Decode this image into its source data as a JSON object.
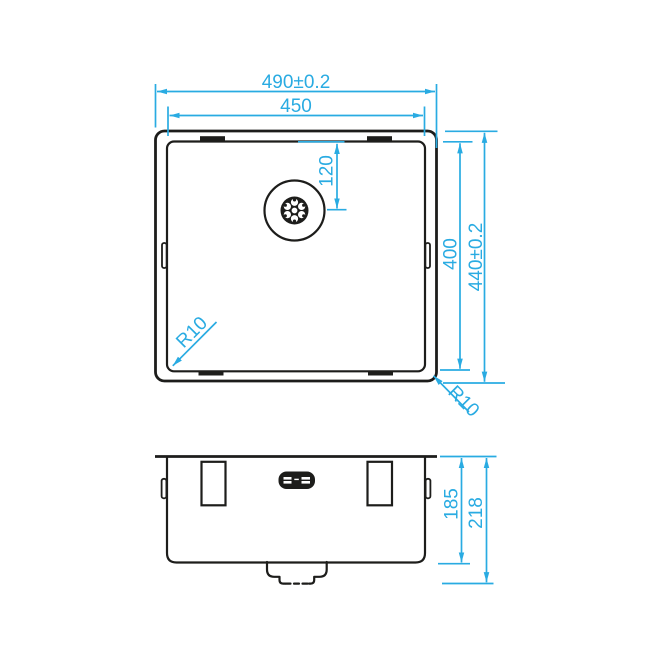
{
  "colors": {
    "dimension": "#29ABE2",
    "outline": "#1D1D1B",
    "background": "#FFFFFF"
  },
  "plan_view": {
    "dim_overall_width": "490±0.2",
    "dim_bowl_width": "450",
    "dim_drain_from_top": "120",
    "dim_bowl_depth": "400",
    "dim_overall_depth": "440±0.2",
    "bowl_corner_radius": "R10",
    "rim_corner_radius": "R10"
  },
  "front_view": {
    "dim_bowl_height": "185",
    "dim_overall_height": "218"
  }
}
